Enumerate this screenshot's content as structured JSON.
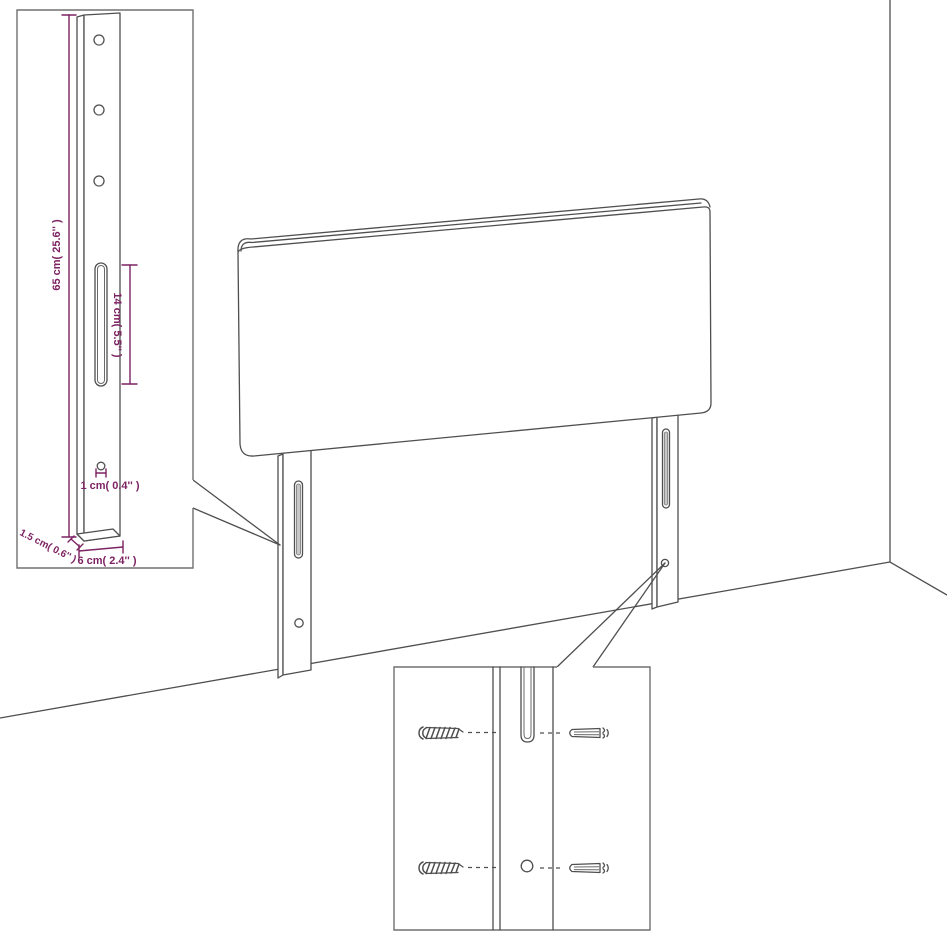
{
  "scene": {
    "title": "headboard-wall-mounting-diagram",
    "background": "#ffffff",
    "line_color": "#4f4f4f",
    "accent_color": "#7d2262",
    "parts": [
      "headboard",
      "left-leg",
      "right-leg",
      "wall-corner",
      "leg-detail-inset",
      "hardware-detail-inset"
    ]
  },
  "leg_detail_inset": {
    "dimensions": {
      "height": "65 cm( 25.6'' )",
      "slot_length": "14 cm( 5.5'' )",
      "hole_diameter": "1 cm( 0.4'' )",
      "thickness": "1.5 cm( 0.6'' )",
      "width": "6 cm( 2.4'' )"
    }
  },
  "hardware_detail_inset": {
    "icons": [
      "screw-icon",
      "screw-icon",
      "wall-plug-icon",
      "wall-plug-icon"
    ],
    "features": [
      "mounting-slot",
      "mounting-hole"
    ]
  }
}
